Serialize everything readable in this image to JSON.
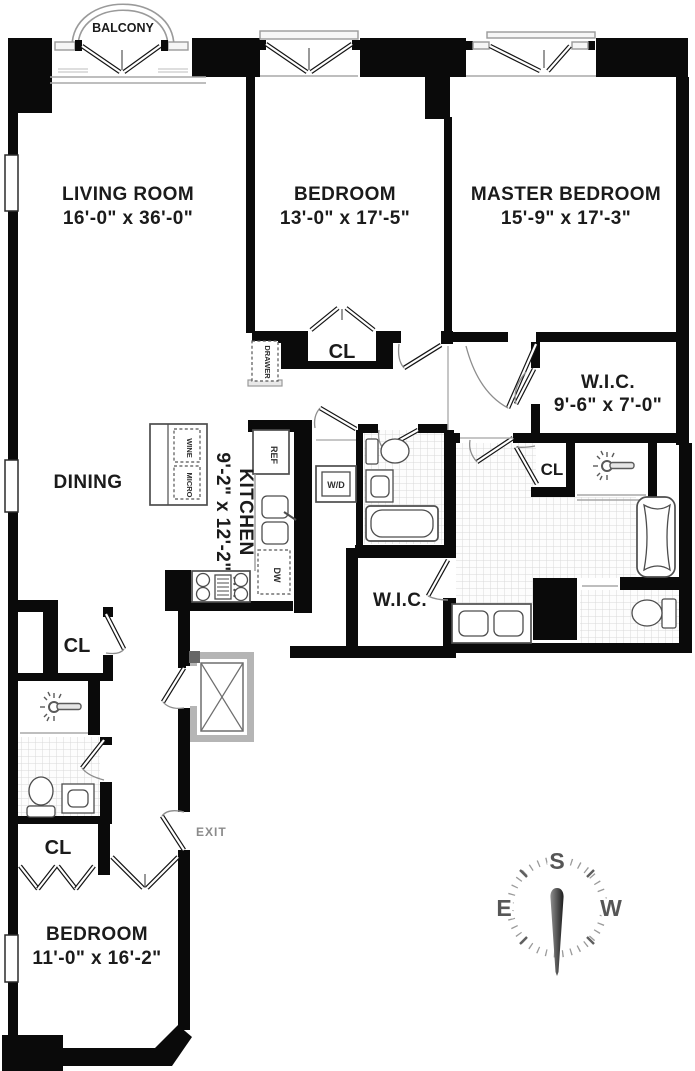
{
  "plan": {
    "rooms": {
      "balcony": {
        "label": "BALCONY"
      },
      "living_room": {
        "label": "LIVING ROOM",
        "dimensions": "16'-0\" x 36'-0\""
      },
      "dining": {
        "label": "DINING"
      },
      "bedroom_2": {
        "label": "BEDROOM",
        "dimensions": "13'-0\" x 17'-5\""
      },
      "master_bedroom": {
        "label": "MASTER BEDROOM",
        "dimensions": "15'-9\" x 17'-3\""
      },
      "walk_in_closet_master": {
        "label": "W.I.C.",
        "dimensions": "9'-6\" x 7'-0\""
      },
      "walk_in_closet_hall": {
        "label": "W.I.C."
      },
      "kitchen": {
        "label": "KITCHEN",
        "dimensions": "9'-2\" x 12'-2\""
      },
      "bedroom_3": {
        "label": "BEDROOM",
        "dimensions": "11'-0\" x 16'-2\""
      }
    },
    "closet_labels": [
      "CL",
      "CL",
      "CL",
      "CL"
    ],
    "exit_label": "EXIT",
    "appliances": {
      "refrigerator": "REF",
      "dishwasher": "DW",
      "washer_dryer": "W/D",
      "wine_cooler": "WINE",
      "microwave": "MICRO",
      "drawer": "DRAWER"
    },
    "compass": {
      "south": "S",
      "east": "E",
      "west": "W"
    },
    "colors": {
      "wall": "#0a0a0a",
      "fixture_outline": "#4d4d4d",
      "tile_line": "#d9d9d9",
      "accent_gray": "#9a9a9a"
    }
  }
}
